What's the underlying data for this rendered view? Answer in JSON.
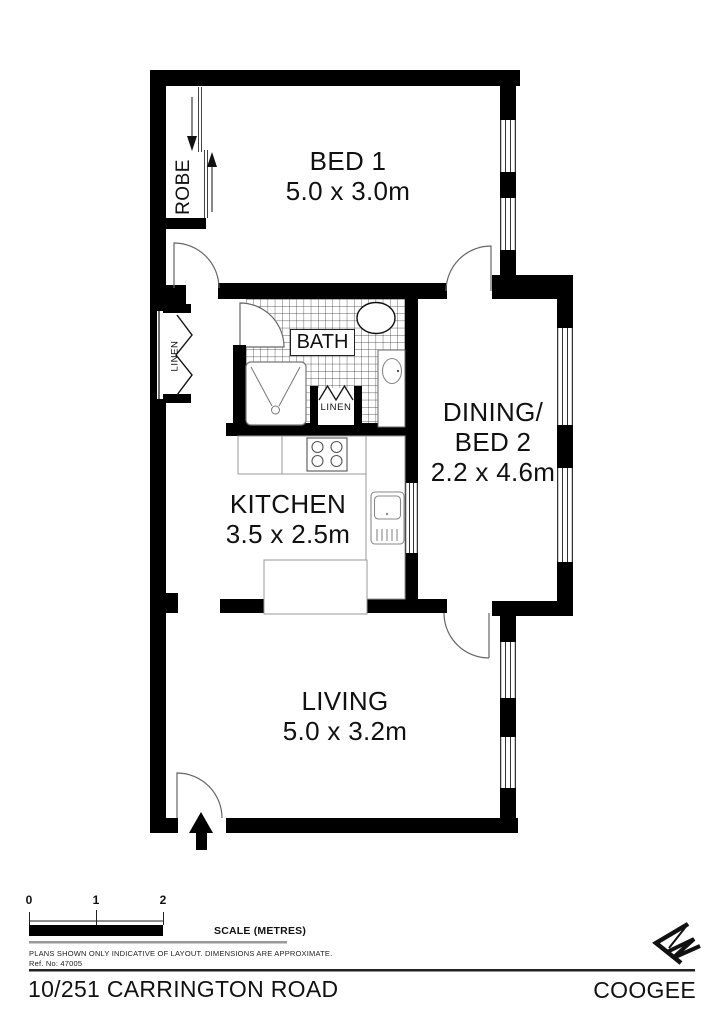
{
  "plan": {
    "rooms": {
      "bed1": {
        "name": "BED 1",
        "dims": "5.0 x 3.0m"
      },
      "dining": {
        "line1": "DINING/",
        "line2": "BED 2",
        "dims": "2.2 x 4.6m"
      },
      "kitchen": {
        "name": "KITCHEN",
        "dims": "3.5 x 2.5m"
      },
      "living": {
        "name": "LIVING",
        "dims": "5.0 x 3.2m"
      },
      "bath": {
        "name": "BATH"
      }
    },
    "closets": {
      "robe": {
        "name": "ROBE"
      },
      "linen_hall": {
        "name": "LINEN"
      },
      "linen_bath": {
        "name": "LINEN"
      }
    }
  },
  "scale_bar": {
    "tick0": "0",
    "tick1": "1",
    "tick2": "2",
    "label": "SCALE (METRES)"
  },
  "notes": {
    "disclaimer": "PLANS SHOWN ONLY INDICATIVE OF LAYOUT.  DIMENSIONS ARE APPROXIMATE.",
    "ref": "Ref. No: 47005"
  },
  "footer": {
    "address": "10/251 CARRINGTON ROAD",
    "suburb": "COOGEE"
  },
  "icons": {
    "north_arrow": "north-arrow",
    "entry_arrow": "entry-arrow"
  },
  "colors": {
    "wall": "#000000",
    "background": "#ffffff",
    "fixture_outline": "#888888",
    "text": "#111111"
  }
}
